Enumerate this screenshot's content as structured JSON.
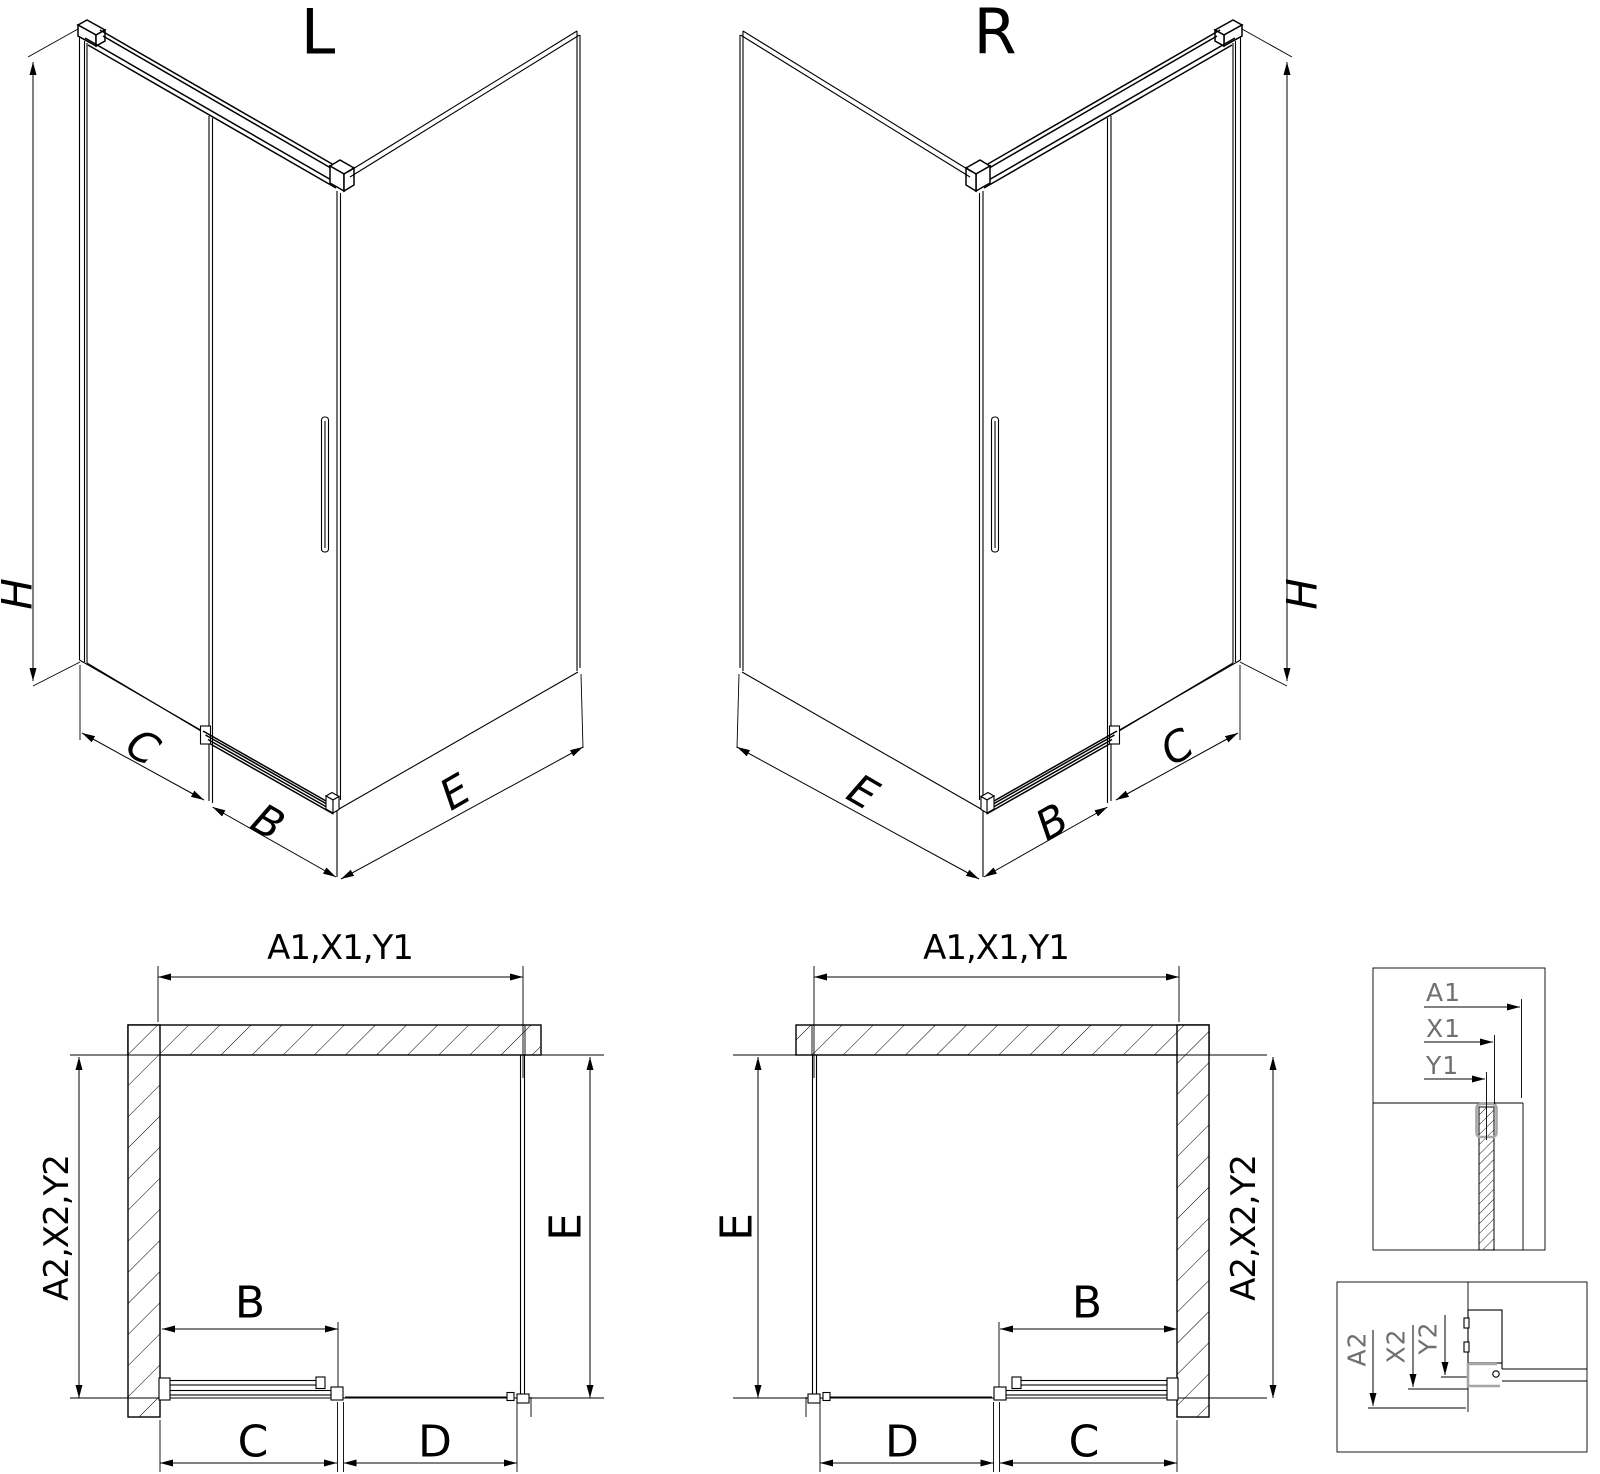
{
  "page": {
    "background": "#ffffff"
  },
  "views": {
    "iso_left": {
      "title": "L",
      "height_label": "H",
      "base_front_label": "C",
      "base_door_label": "B",
      "base_side_label": "E"
    },
    "iso_right": {
      "title": "R",
      "height_label": "H",
      "base_front_label": "C",
      "base_door_label": "B",
      "base_side_label": "E"
    },
    "plan_left": {
      "width_label": "A1,X1,Y1",
      "depth_label": "A2,X2,Y2",
      "side_label": "E",
      "door_label": "B",
      "fixed_label": "C",
      "opening_label": "D"
    },
    "plan_right": {
      "width_label": "A1,X1,Y1",
      "depth_label": "A2,X2,Y2",
      "side_label": "E",
      "door_label": "B",
      "fixed_label": "C",
      "opening_label": "D"
    },
    "detail_top": {
      "a1": "A1",
      "x1": "X1",
      "y1": "Y1"
    },
    "detail_bottom": {
      "a2": "A2",
      "x2": "X2",
      "y2": "Y2"
    }
  },
  "colors": {
    "line": "#000000",
    "detail_text": "#6f6f6f",
    "profile_highlight": "#a6a6a6",
    "background": "#ffffff"
  }
}
